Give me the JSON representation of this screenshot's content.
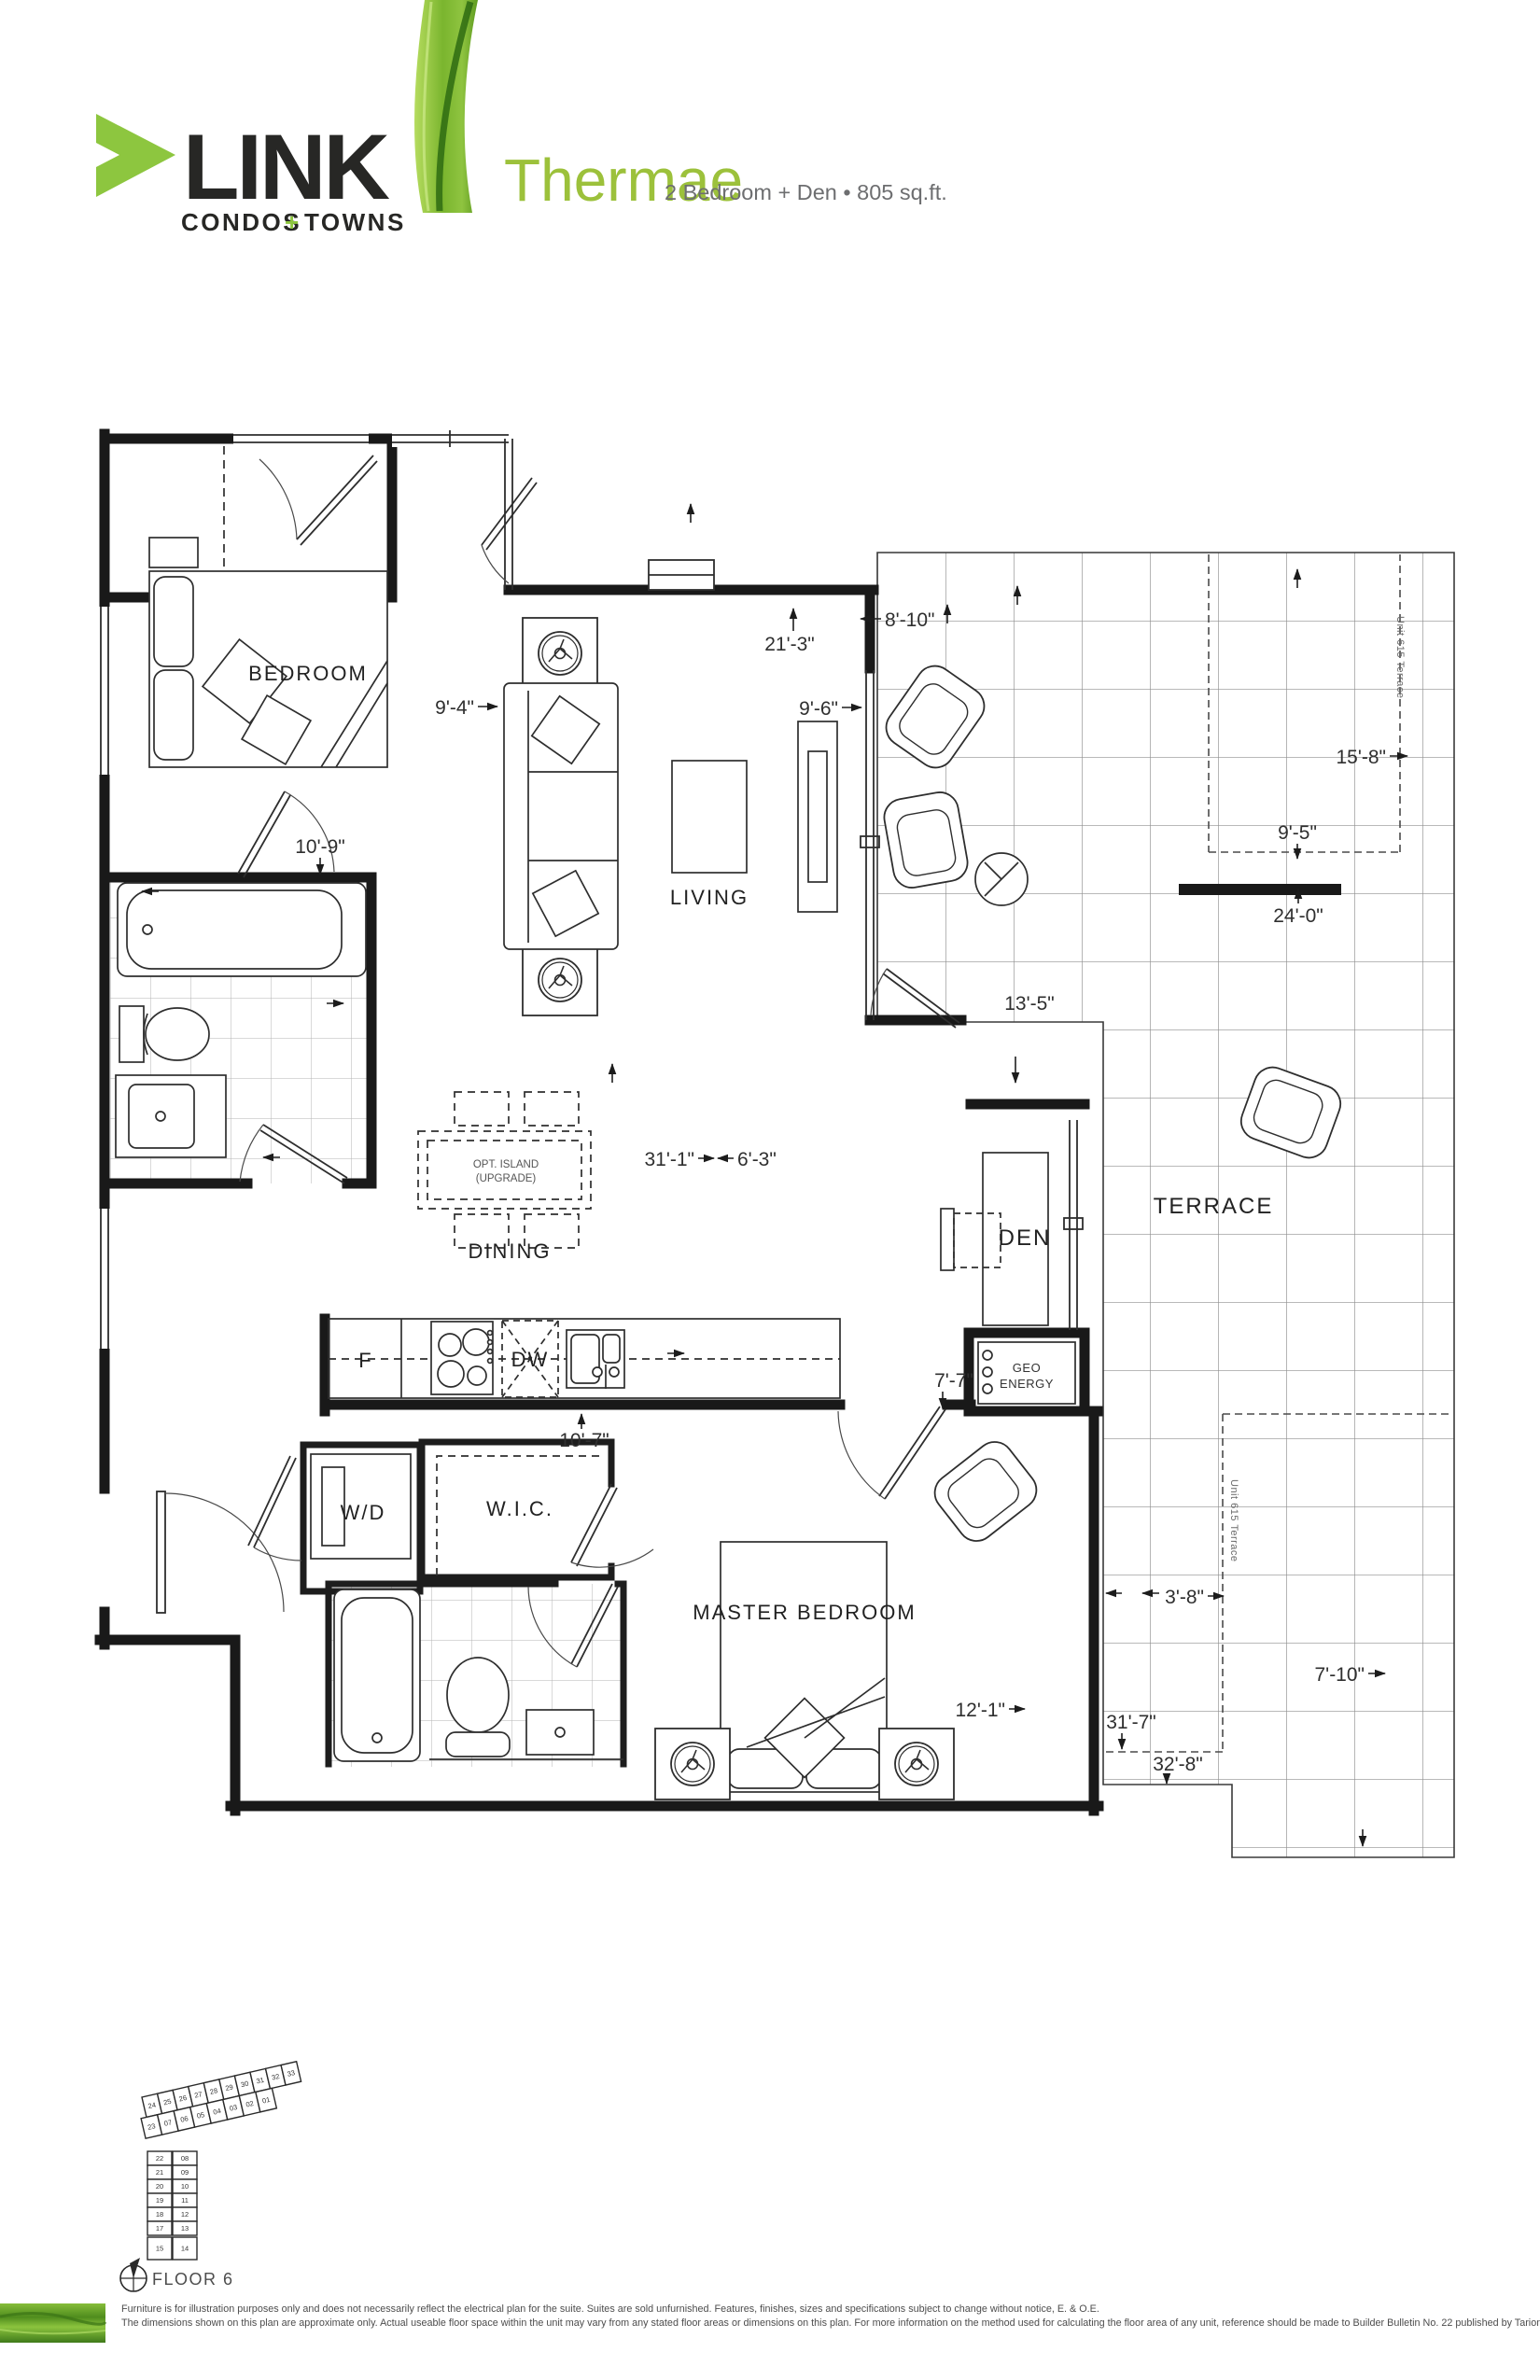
{
  "header": {
    "logo": {
      "name": "LINK",
      "tagline_condos": "CONDOS",
      "tagline_plus": "+",
      "tagline_towns": "TOWNS"
    },
    "plan": {
      "name": "Thermae",
      "specs": "2 Bedroom + Den • 805 sq.ft."
    }
  },
  "rooms": {
    "bedroom": "BEDROOM",
    "living": "LIVING",
    "dining": "DINING",
    "master_bedroom": "MASTER BEDROOM",
    "den": "DEN",
    "terrace": "TERRACE",
    "wic": "W.I.C.",
    "wd": "W/D",
    "fridge": "F",
    "dishwasher": "DW",
    "geo_line1": "GEO",
    "geo_line2": "ENERGY",
    "island_line1": "OPT. ISLAND",
    "island_line2": "(UPGRADE)",
    "unit_terrace_upper": "Unit 615 Terrace",
    "unit_terrace_lower": "Unit 615 Terrace"
  },
  "dimensions": {
    "d21_3": "21'-3\"",
    "d8_10": "8'-10\"",
    "d9_6": "9'-6\"",
    "d9_4": "9'-4\"",
    "d10_9": "10'-9\"",
    "d15_8": "15'-8\"",
    "d9_5": "9'-5\"",
    "d24_0": "24'-0\"",
    "d13_5": "13'-5\"",
    "d31_1": "31'-1\"",
    "d6_3": "6'-3\"",
    "d7_7": "7'-7\"",
    "d10_7": "10'-7\"",
    "d12_1": "12'-1\"",
    "d3_8": "3'-8\"",
    "d7_10": "7'-10\"",
    "d31_7": "31'-7\"",
    "d32_8": "32'-8\""
  },
  "keyplan": {
    "floor_label": "FLOOR 6",
    "wing_top_row1": [
      "24",
      "25",
      "26",
      "27",
      "28",
      "29",
      "30",
      "31",
      "32",
      "33"
    ],
    "wing_top_row2": [
      "23",
      "07",
      "06",
      "05",
      "04",
      "03",
      "02",
      "01"
    ],
    "wing_left": [
      "22",
      "21",
      "20",
      "19",
      "18",
      "17"
    ],
    "wing_right": [
      "08",
      "09",
      "10",
      "11",
      "12",
      "13"
    ],
    "highlighted": [
      "15",
      "14"
    ]
  },
  "footer": {
    "disclaimer_line1": "Furniture is for illustration purposes only and does not necessarily reflect the electrical plan for the suite. Suites are sold unfurnished. Features, finishes, sizes and specifications subject to change without notice, E. & O.E.",
    "disclaimer_line2": "The dimensions shown on this plan are approximate only.  Actual useable floor space within the unit may vary from any stated floor areas or dimensions on this plan.  For more information on the method used for calculating the floor area of any unit,  reference should be made to Builder Bulletin No. 22 published by Tarion."
  },
  "colors": {
    "accent_green": "#8DC63F",
    "title_green": "#9CC13B",
    "logo_dark": "#272725",
    "subtitle_gray": "#6D6E70",
    "wall_black": "#191919"
  }
}
